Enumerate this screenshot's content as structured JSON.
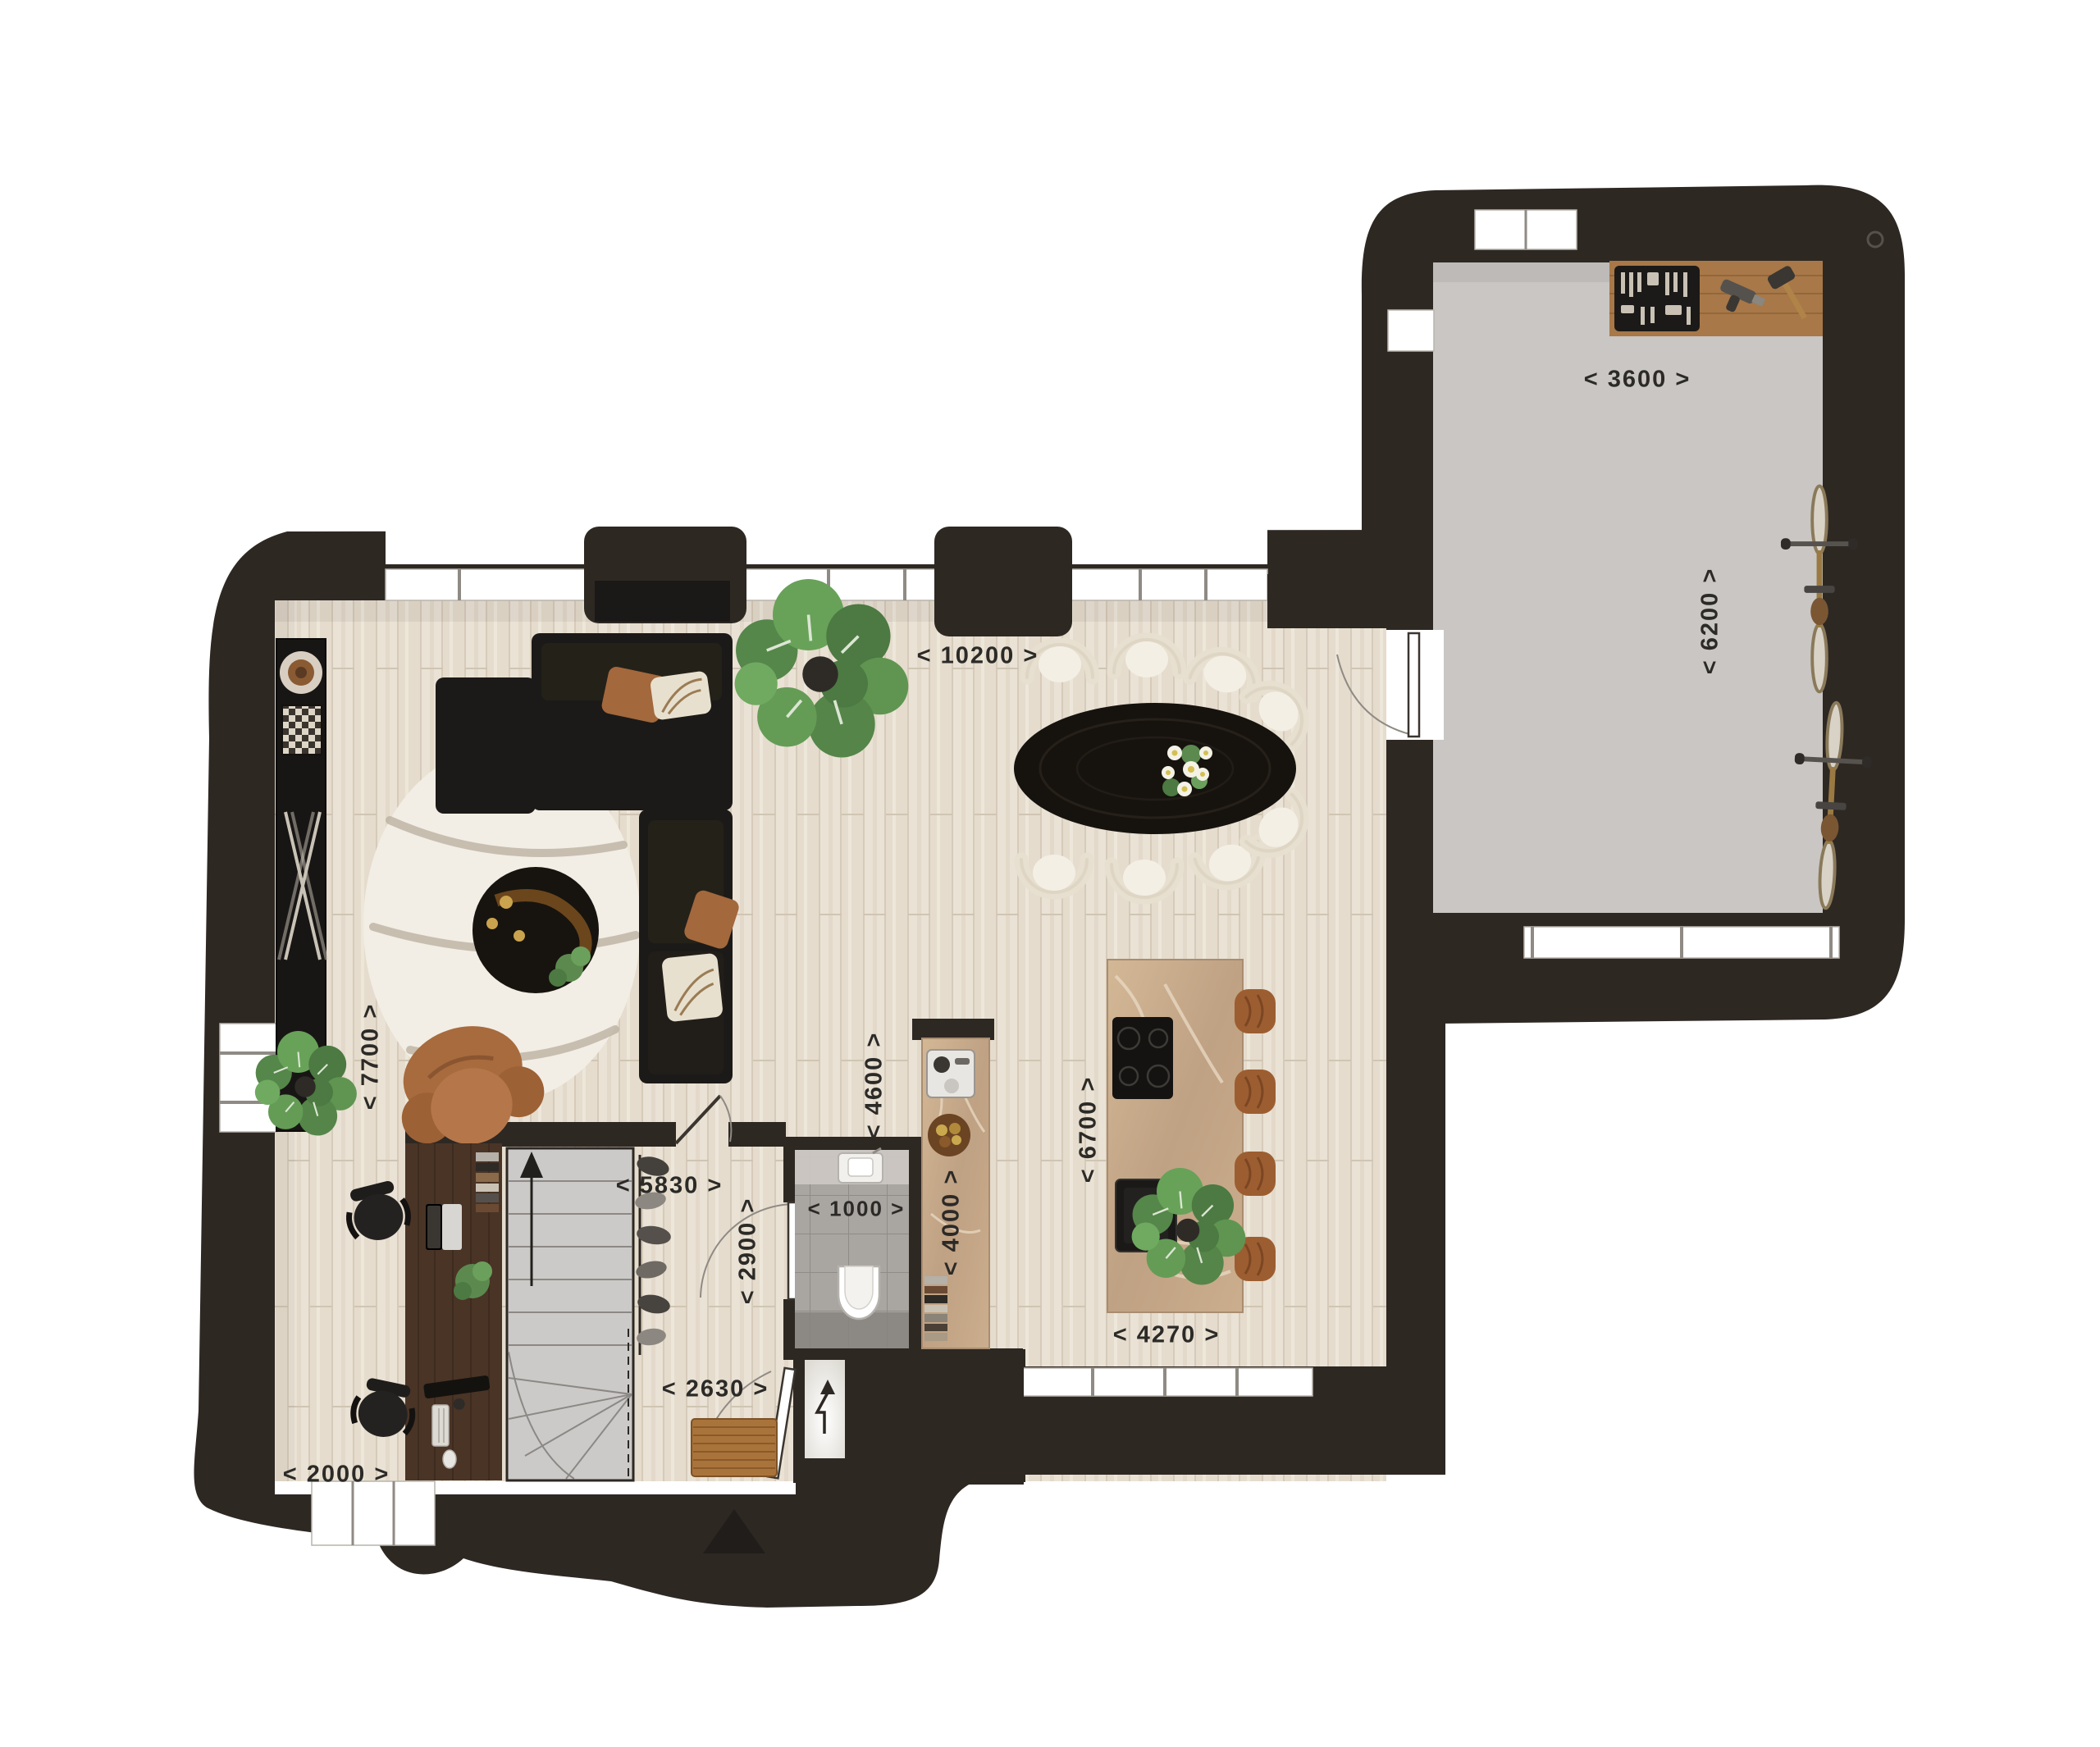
{
  "floor_plan": {
    "type": "residential-ground-floor-plan",
    "dimension_labels": [
      {
        "id": "garage-width",
        "text": "< 3600 >",
        "orientation": "horizontal"
      },
      {
        "id": "garage-depth",
        "text": "< 6200 >",
        "orientation": "vertical"
      },
      {
        "id": "living-width",
        "text": "< 10200 >",
        "orientation": "horizontal"
      },
      {
        "id": "living-depth",
        "text": "< 7700 >",
        "orientation": "vertical"
      },
      {
        "id": "living-span",
        "text": "< 5830 >",
        "orientation": "horizontal"
      },
      {
        "id": "kitchen-depth",
        "text": "< 4600 >",
        "orientation": "vertical"
      },
      {
        "id": "island-span",
        "text": "< 6700 >",
        "orientation": "vertical"
      },
      {
        "id": "counter-span",
        "text": "< 4000 >",
        "orientation": "vertical"
      },
      {
        "id": "toilet-width",
        "text": "< 1000 >",
        "orientation": "horizontal"
      },
      {
        "id": "hall-depth",
        "text": "< 2900 >",
        "orientation": "vertical"
      },
      {
        "id": "entry-width",
        "text": "< 2630 >",
        "orientation": "horizontal"
      },
      {
        "id": "office-width",
        "text": "< 2000 >",
        "orientation": "horizontal"
      },
      {
        "id": "kitchen-width",
        "text": "< 4270 >",
        "orientation": "horizontal"
      }
    ],
    "colors": {
      "wall": "#2e2823",
      "wood_floor": "#e9e1d4",
      "garage_floor": "#c9c6c3",
      "tile_floor": "#a8a4a0",
      "marble": "#c8ab8b",
      "sofa_black": "#1c1a18",
      "accent_brown": "#a16a3c",
      "plant_green": "#5e8f52",
      "rug_cream": "#f2eee5",
      "label_text": "#2b2a27"
    },
    "furniture_icons": [
      "sectional-sofa",
      "lounge-chair",
      "coffee-table",
      "area-rug",
      "console-sideboard",
      "tv-cabinet",
      "monstera-plant",
      "dining-table",
      "dining-chair",
      "flower-bouquet",
      "kitchen-island",
      "induction-hob",
      "island-sink",
      "bar-stool",
      "tall-counter",
      "coffee-machine",
      "fruit-bowl",
      "cookbooks",
      "wall-toilet",
      "washbasin",
      "staircase",
      "up-arrow",
      "coat-rack",
      "desk",
      "office-chair",
      "laptop",
      "monitor",
      "keyboard",
      "desk-plant",
      "doormat",
      "meter-cupboard",
      "electric-arrow",
      "workbench",
      "toolbox",
      "drill",
      "mallet",
      "bicycle",
      "entrance-marker",
      "wall-vent"
    ]
  }
}
